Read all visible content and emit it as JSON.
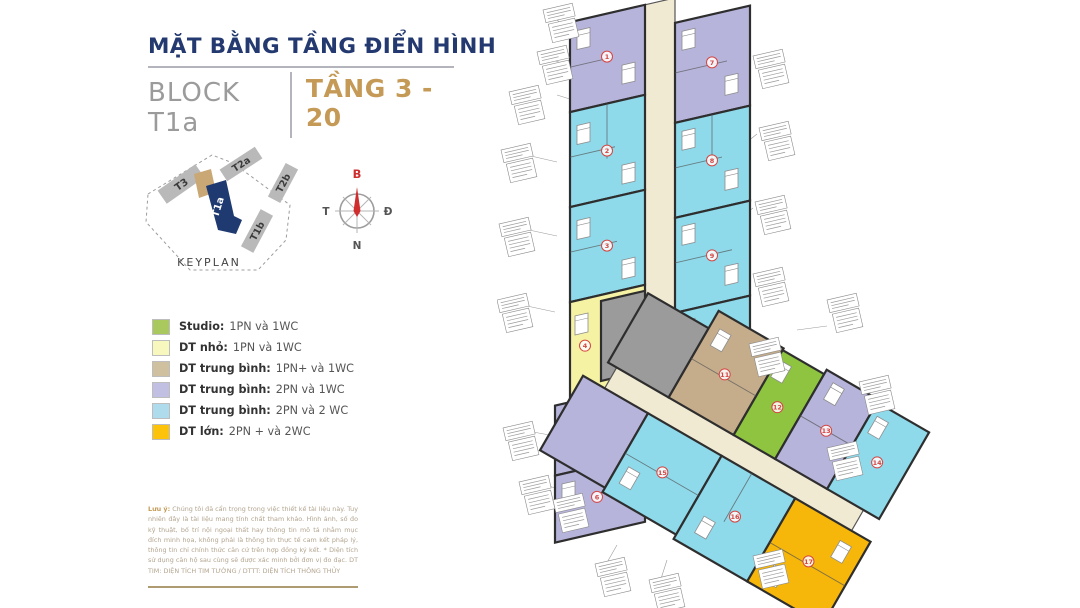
{
  "header": {
    "title": "MẶT BẰNG TẦNG ĐIỂN HÌNH",
    "block": "BLOCK T1a",
    "floors": "TẦNG 3 - 20"
  },
  "keyplan": {
    "label": "KEYPLAN",
    "buildings": [
      {
        "name": "T3",
        "highlighted": false
      },
      {
        "name": "T2a",
        "highlighted": false
      },
      {
        "name": "T2b",
        "highlighted": false
      },
      {
        "name": "T1b",
        "highlighted": false
      },
      {
        "name": "T1a",
        "highlighted": true
      }
    ]
  },
  "compass": {
    "north": "B",
    "south": "N",
    "east": "Đ",
    "west": "T"
  },
  "legend": {
    "items": [
      {
        "color": "#a9c85e",
        "label": "Studio:",
        "value": "1PN và 1WC"
      },
      {
        "color": "#f8f7bd",
        "label": "DT nhỏ:",
        "value": "1PN  và 1WC"
      },
      {
        "color": "#cfc19f",
        "label": "DT trung bình:",
        "value": "1PN+ và 1WC"
      },
      {
        "color": "#c2c0e2",
        "label": "DT trung bình:",
        "value": "2PN và 1WC"
      },
      {
        "color": "#aedcec",
        "label": "DT trung bình:",
        "value": "2PN và 2 WC"
      },
      {
        "color": "#fdc20a",
        "label": "DT lớn:",
        "value": "2PN + và 2WC"
      }
    ]
  },
  "note": {
    "label": "Lưu ý:",
    "text": " Chúng tôi đã cẩn trọng trong việc thiết kế tài liệu này. Tuy nhiên đây là tài liệu mang tính chất tham khảo. Hình ảnh, số đo kỹ thuật, bố trí nội ngoại thất hay thông tin mô tả nhằm mục đích minh họa, không phải là thông tin thực tế cam kết pháp lý, thông tin chỉ chính thức căn cứ trên hợp đồng ký kết. * Diện tích sử dụng căn hộ sau cùng sẽ được xác minh bởi đơn vị đo đạc. DT TIM: DIỆN TÍCH TIM TƯỜNG / DTTT: DIỆN TÍCH THÔNG THỦY"
  },
  "plan": {
    "units": [
      "1",
      "2",
      "3",
      "4",
      "5",
      "6",
      "7",
      "8",
      "9",
      "10",
      "11",
      "12",
      "13",
      "14",
      "15",
      "16",
      "17"
    ],
    "colors": {
      "purple": "#b7b4db",
      "blue": "#8ed9ea",
      "yellow": "#f6f2a3",
      "green": "#8ec43f",
      "tan": "#c5ad8c",
      "orange": "#f7b70a",
      "core": "#9b9b9b",
      "corridor": "#f1ead3"
    }
  }
}
